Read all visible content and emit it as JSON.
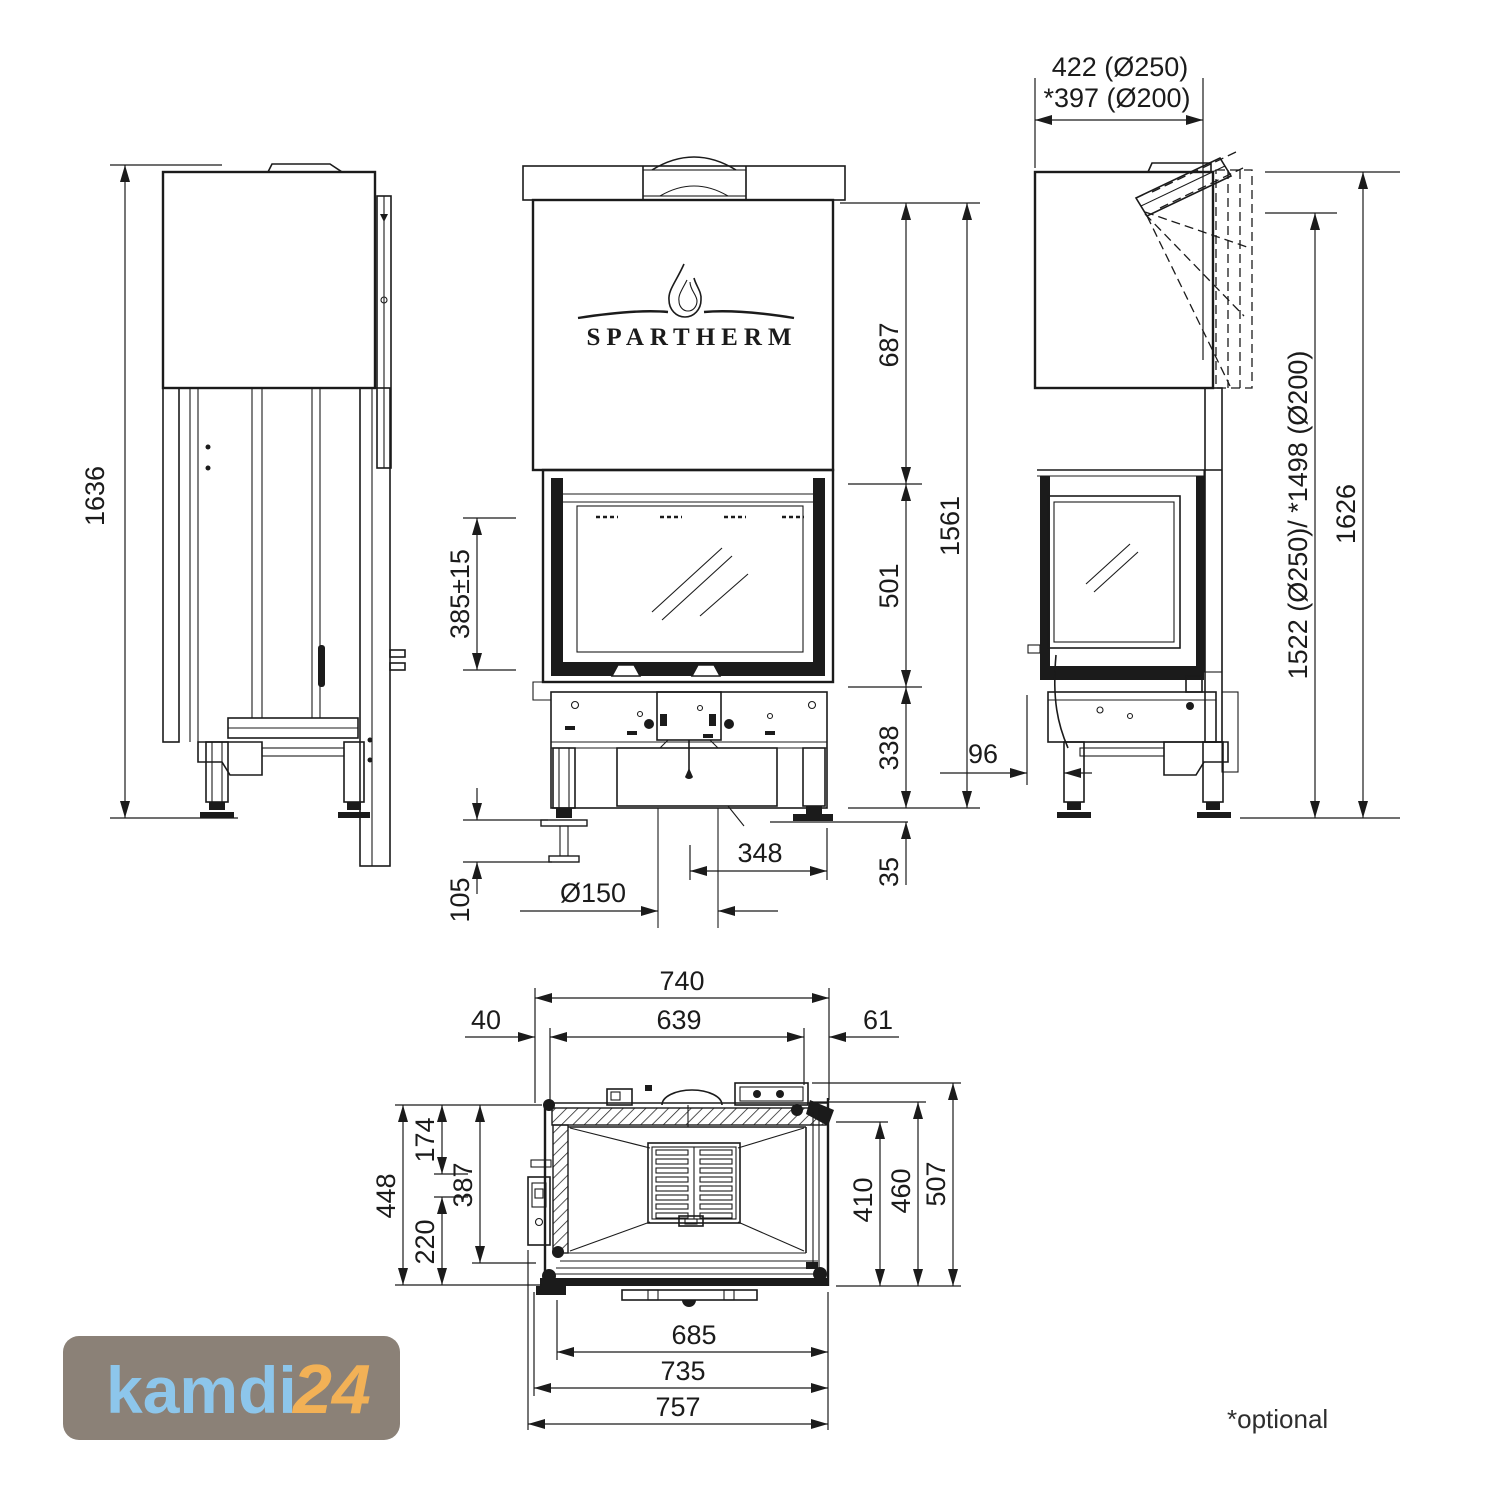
{
  "branding": {
    "spartherm": "SPARTHERM",
    "kamdi": "kamdi",
    "kamdi_suffix": "24",
    "logo_bg": "#8b8177",
    "kamdi_color": "#8dc6eb",
    "suffix_color": "#f2b156"
  },
  "footnote": "*optional",
  "views": {
    "side_left": {
      "overall_height": "1636"
    },
    "front": {
      "hood_height": "687",
      "total_height": "1561",
      "firebox_height": "501",
      "base_height": "338",
      "foot_height": "35",
      "glass_sill_height": "385±15",
      "foot_adjust": "105",
      "flue_offset": "348",
      "air_intake": "Ø150"
    },
    "side_right": {
      "flue_offset_250": "422 (Ø250)",
      "flue_offset_200": "*397 (Ø200)",
      "flue_height": "1522 (Ø250)/ *1498 (Ø200)",
      "overall_height": "1626",
      "leg_offset": "96"
    },
    "plan": {
      "body_width": "740",
      "inner_width": "639",
      "offset_left": "40",
      "offset_right": "61",
      "depth_448": "448",
      "depth_174": "174",
      "depth_387": "387",
      "depth_220": "220",
      "width_410": "410",
      "width_460": "460",
      "width_507": "507",
      "front_width_685": "685",
      "front_width_735": "735",
      "front_width_757": "757"
    }
  }
}
